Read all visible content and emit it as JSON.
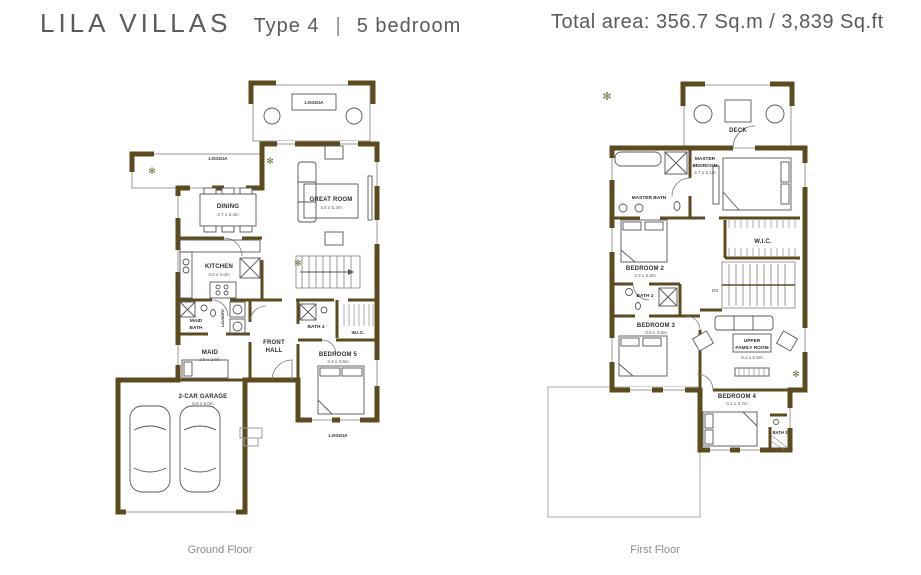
{
  "header": {
    "brand": "LILA VILLAS",
    "type": "Type 4",
    "divider": "|",
    "bedrooms": "5 bedroom",
    "total_area": "Total area: 356.7 Sq.m / 3,839 Sq.ft"
  },
  "colors": {
    "wall": "#5d4b20",
    "plot_outline": "#c9c9c9",
    "heading_text": "#5c5a56"
  },
  "icons": {
    "plant": "✻"
  },
  "ground_floor": {
    "caption": "Ground Floor",
    "rooms": {
      "loggia_top": {
        "lines": [
          "LOGGIA"
        ]
      },
      "loggia_left": {
        "lines": [
          "LOGGIA"
        ]
      },
      "dining": {
        "lines": [
          "DINING"
        ],
        "dims": "3.7 x 3.4m"
      },
      "great_room": {
        "lines": [
          "GREAT ROOM"
        ],
        "dims": "4.5 x 5.4m"
      },
      "kitchen": {
        "lines": [
          "KITCHEN"
        ],
        "dims": "3.6 x 3.0m"
      },
      "laundry": {
        "lines": [
          "LAUNDRY"
        ]
      },
      "maid_bath": {
        "lines": [
          "MAID",
          "BATH"
        ]
      },
      "maid": {
        "lines": [
          "MAID"
        ],
        "dims": "2.5 x 2.6m"
      },
      "front_hall": {
        "lines": [
          "FRONT",
          "HALL"
        ]
      },
      "bath_4": {
        "lines": [
          "BATH 4"
        ]
      },
      "wic": {
        "lines": [
          "W.I.C."
        ]
      },
      "bedroom_5": {
        "lines": [
          "BEDROOM 5"
        ],
        "dims": "3.4 x 3.5m"
      },
      "garage": {
        "lines": [
          "2-CAR GARAGE"
        ],
        "dims": "6.0 x 6.0m"
      },
      "loggia_bottom": {
        "lines": [
          "LOGGIA"
        ]
      }
    }
  },
  "first_floor": {
    "caption": "First Floor",
    "stairs_label": "DN",
    "rooms": {
      "deck": {
        "lines": [
          "DECK"
        ]
      },
      "master_bedroom": {
        "lines": [
          "MASTER",
          "BEDROOM"
        ],
        "dims": "4.7 x 5.1m"
      },
      "master_bath": {
        "lines": [
          "MASTER BATH"
        ]
      },
      "wic": {
        "lines": [
          "W.I.C."
        ]
      },
      "bedroom_2": {
        "lines": [
          "BEDROOM 2"
        ],
        "dims": "3.3 x 3.5m"
      },
      "bath_2": {
        "lines": [
          "BATH 2"
        ]
      },
      "bedroom_3": {
        "lines": [
          "BEDROOM 3"
        ],
        "dims": "3.6 x 3.6m"
      },
      "upper_family_room": {
        "lines": [
          "UPPER",
          "FAMILY ROOM"
        ],
        "dims": "5.4 x 5.5m"
      },
      "bedroom_4": {
        "lines": [
          "BEDROOM 4"
        ],
        "dims": "3.1 x 3.7m"
      },
      "bath_3": {
        "lines": [
          "BATH 3"
        ]
      }
    }
  }
}
